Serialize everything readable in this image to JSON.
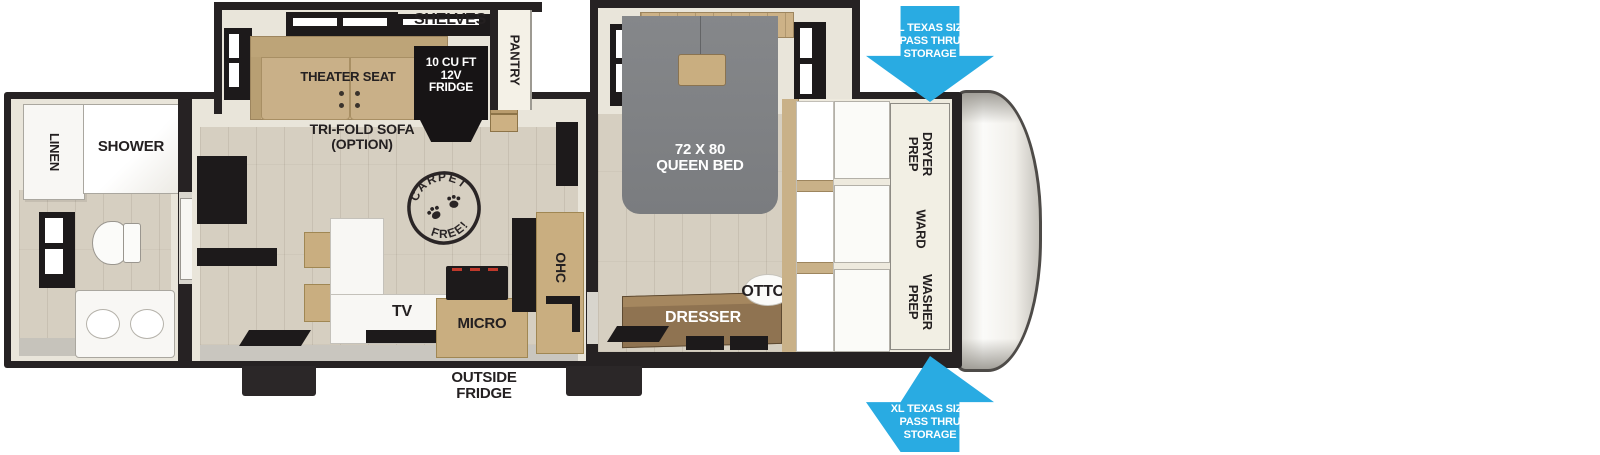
{
  "floorplan": {
    "rooms": {
      "bathroom": {
        "linen": "LINEN",
        "shower": "SHOWER"
      },
      "living": {
        "theater_seat": "THEATER SEAT",
        "trifold_sofa": "TRI-FOLD SOFA\n(OPTION)",
        "shelves": "SHELVES",
        "pantry": "PANTRY",
        "fridge": "10 CU FT\n12V\nFRIDGE",
        "carpet_stamp_top": "CARPET",
        "carpet_stamp_bottom": "FREE!",
        "ohc": "OHC",
        "tv": "TV",
        "micro": "MICRO"
      },
      "bedroom": {
        "queen_bed": "72 X 80\nQUEEN BED",
        "ottoman": "OTTOMAN",
        "dresser": "DRESSER"
      },
      "front_closet": {
        "dryer_prep": "DRYER\nPREP",
        "ward": "WARD",
        "washer_prep": "WASHER\nPREP"
      },
      "exterior": {
        "outside_fridge": "OUTSIDE\nFRIDGE",
        "pass_thru_storage": "XL TEXAS SIZE\nPASS THRU\nSTORAGE"
      }
    },
    "colors": {
      "arrow_blue": "#29abe2",
      "wall_dark": "#262223",
      "floor_beige": "#d6cfc1",
      "wood_tan": "#c9ae80",
      "bed_gray": "#7d7f83",
      "dresser_brown": "#8f7351",
      "cream": "#e9e5da"
    }
  }
}
